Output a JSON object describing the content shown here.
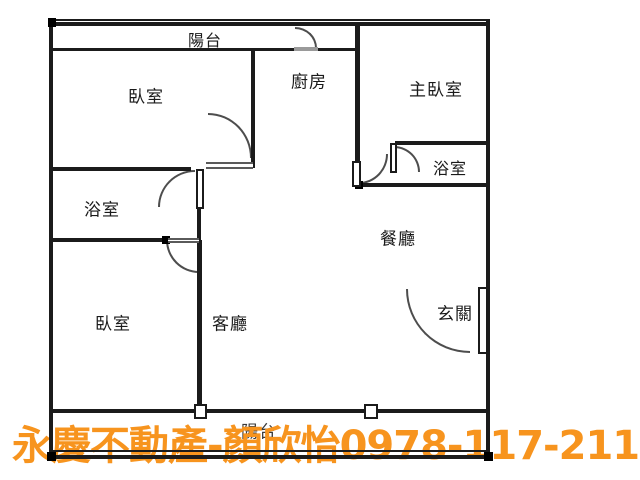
{
  "rooms": {
    "balcony_top": "陽台",
    "bedroom_top_left": "臥室",
    "kitchen": "廚房",
    "master_bedroom": "主臥室",
    "bathroom_master": "浴室",
    "bathroom_left": "浴室",
    "dining_room": "餐廳",
    "bedroom_bottom_left": "臥室",
    "living_room": "客廳",
    "entryway": "玄關",
    "balcony_bottom": "陽台"
  },
  "watermark": {
    "text": "永慶不動產-顏欣怡0978-117-211",
    "agency": "永慶不動產",
    "agent": "顏欣怡",
    "phone": "0978-117-211",
    "color": "#F7941E"
  },
  "colors": {
    "wall": "#1b1b1b",
    "label": "#1a1a1a",
    "door_arc": "#4d4d4d",
    "background": "#ffffff"
  }
}
